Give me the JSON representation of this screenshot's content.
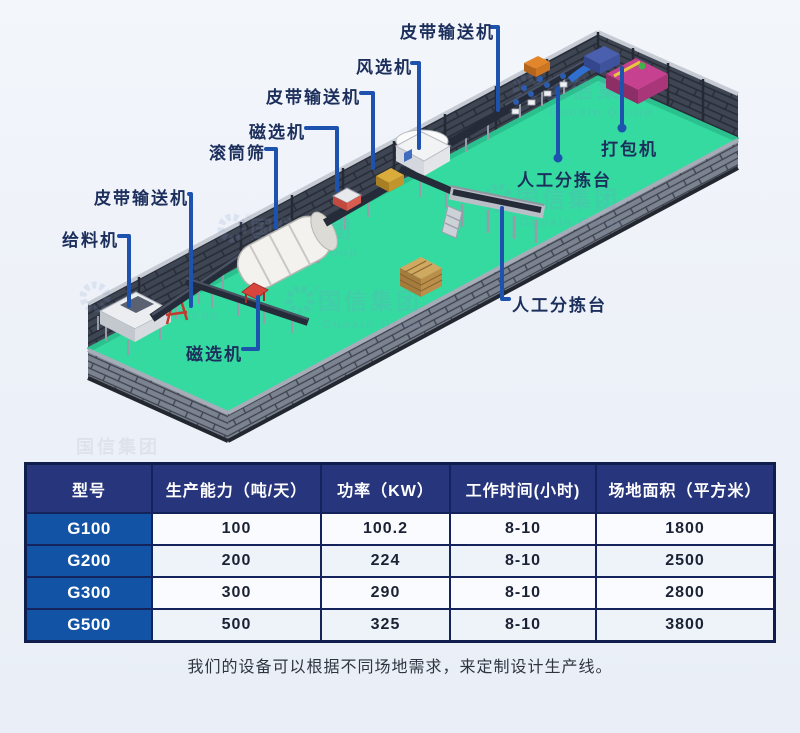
{
  "diagram": {
    "labels": {
      "belt_conveyor": "皮带输送机",
      "air_separator": "风选机",
      "magnetic_separator": "磁选机",
      "trommel_screen": "滚筒筛",
      "feeder": "给料机",
      "baler": "打包机",
      "manual_sorting": "人工分拣台"
    },
    "watermark": {
      "cn": "国信集团",
      "en": "Guoxin Group",
      "reg": "®"
    },
    "colors": {
      "floor_green": "#35daa1",
      "wall_dark": "#3e4553",
      "label_line_blue": "#1d52ae",
      "label_text_navy": "#1c2f5c"
    }
  },
  "table": {
    "headers": [
      "型号",
      "生产能力（吨/天）",
      "功率（KW）",
      "工作时间(小时)",
      "场地面积（平方米）"
    ],
    "rows": [
      {
        "model": "G100",
        "capacity": "100",
        "power": "100.2",
        "hours": "8-10",
        "area": "1800"
      },
      {
        "model": "G200",
        "capacity": "200",
        "power": "224",
        "hours": "8-10",
        "area": "2500"
      },
      {
        "model": "G300",
        "capacity": "300",
        "power": "290",
        "hours": "8-10",
        "area": "2800"
      },
      {
        "model": "G500",
        "capacity": "500",
        "power": "325",
        "hours": "8-10",
        "area": "3800"
      }
    ],
    "header_bg": "#27357c",
    "model_col_bg": "#1253a6"
  },
  "caption": "我们的设备可以根据不同场地需求，来定制设计生产线。"
}
